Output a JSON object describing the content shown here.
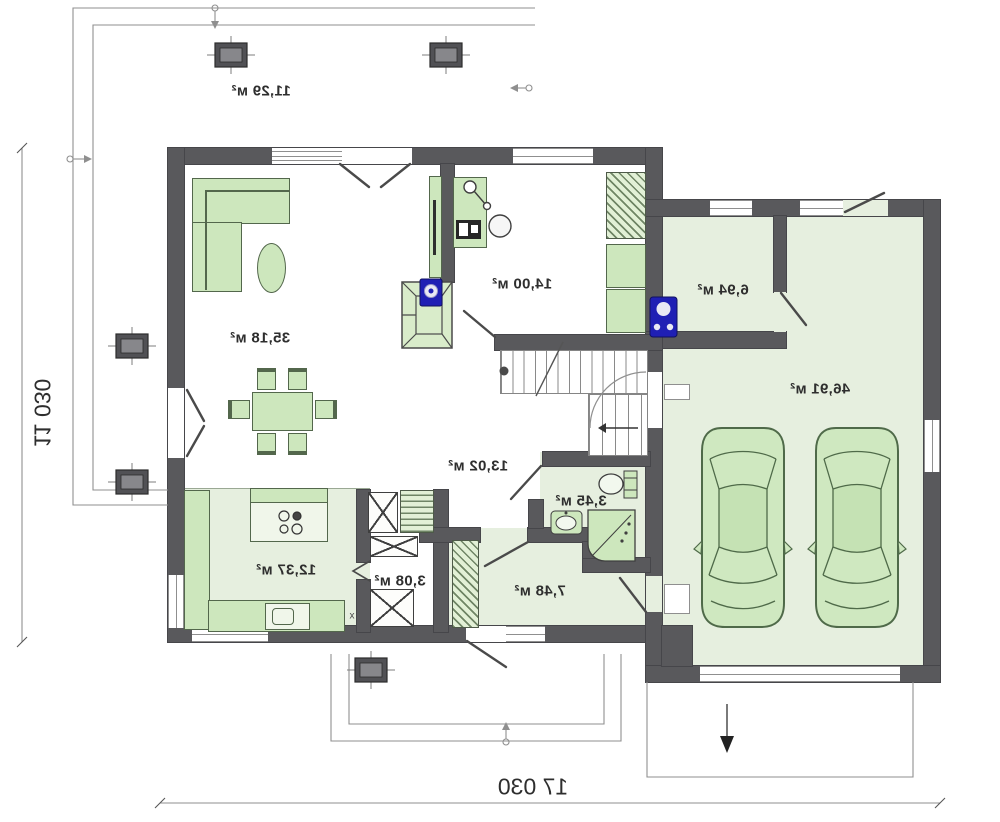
{
  "title": "house-ground-floor-plan",
  "flags": {
    "mirrored_print": true
  },
  "rooms": [
    {
      "id": "terrace",
      "area_label": "11,29 м²"
    },
    {
      "id": "living-room",
      "area_label": "35,18 м²"
    },
    {
      "id": "office",
      "area_label": "14,00 м²"
    },
    {
      "id": "utility-room",
      "area_label": "6,94 м²"
    },
    {
      "id": "garage",
      "area_label": "46,91 м²"
    },
    {
      "id": "hall",
      "area_label": "13,02 м²"
    },
    {
      "id": "bathroom",
      "area_label": "3,45 м²"
    },
    {
      "id": "kitchen",
      "area_label": "12,37 м²"
    },
    {
      "id": "pantry",
      "area_label": "3,08 м²"
    },
    {
      "id": "corridor",
      "area_label": "7,48 м²"
    }
  ],
  "dimensions": {
    "overall_width": "17 030",
    "overall_depth": "11 030"
  },
  "annotations": {
    "kitchen_counter_mark": "x"
  },
  "colors": {
    "wall": "#59595c",
    "floor_tile": "#e6efdf",
    "furniture": "#cde7bd",
    "fixture_blue": "#1f1fb4",
    "linework": "#8f8f8f",
    "text": "#2e2e2e"
  }
}
